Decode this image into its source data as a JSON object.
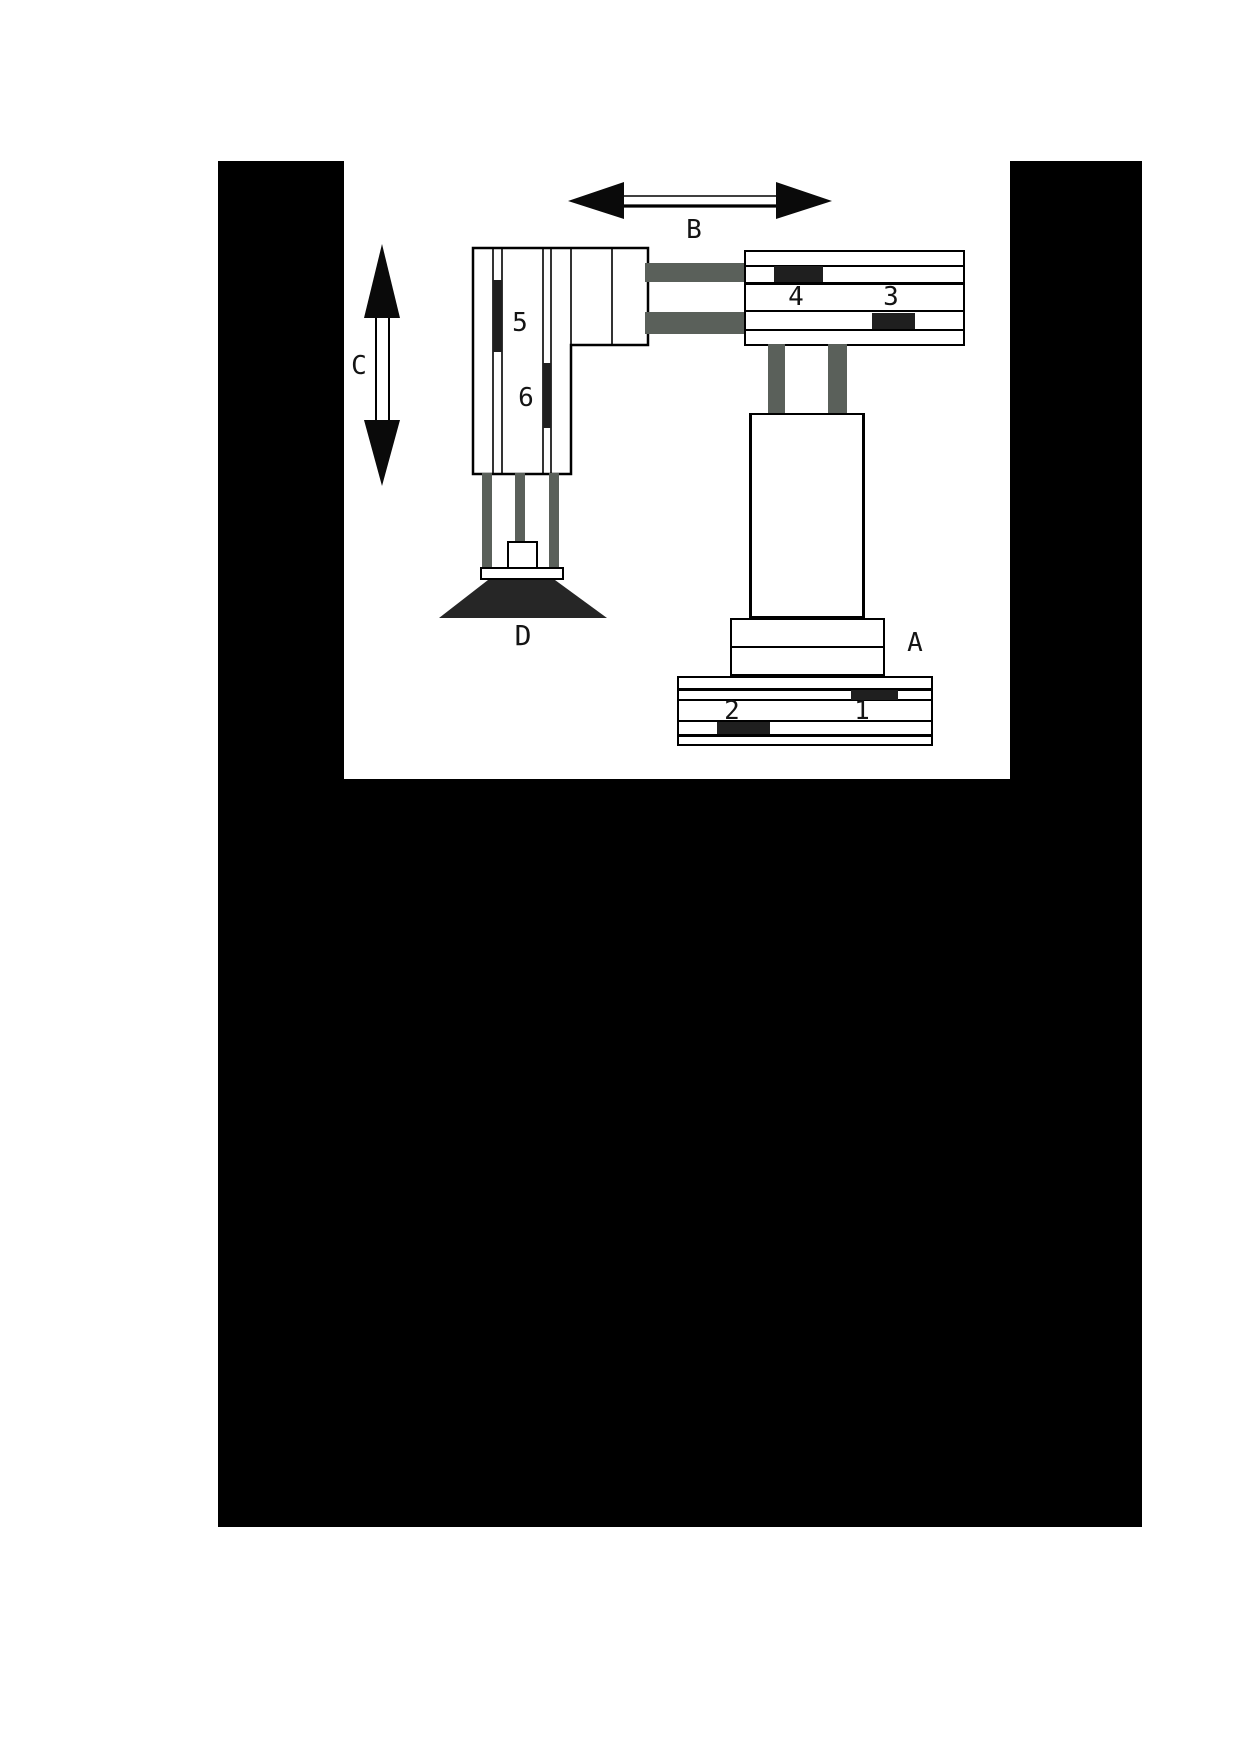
{
  "page": {
    "kind": "scanned exam figure, pick-and-place robot arm diagram",
    "background": "#ffffff"
  },
  "frame": {
    "color": "#000000"
  },
  "diagram": {
    "colors": {
      "ink": "#000000",
      "sensor_fill": "#1f1f1f",
      "rail_gray": "#5a605a",
      "suction_cup": "#262626",
      "paper": "#ffffff"
    },
    "labels": {
      "horizontal_motion_arrow": "B",
      "vertical_motion_arrow": "C",
      "base_assembly": "A",
      "suction_gripper": "D",
      "base_sensor_right": "1",
      "base_sensor_left": "2",
      "arm_sensor_right": "3",
      "arm_sensor_left": "4",
      "vertical_sensor_upper": "5",
      "vertical_sensor_lower": "6"
    }
  }
}
